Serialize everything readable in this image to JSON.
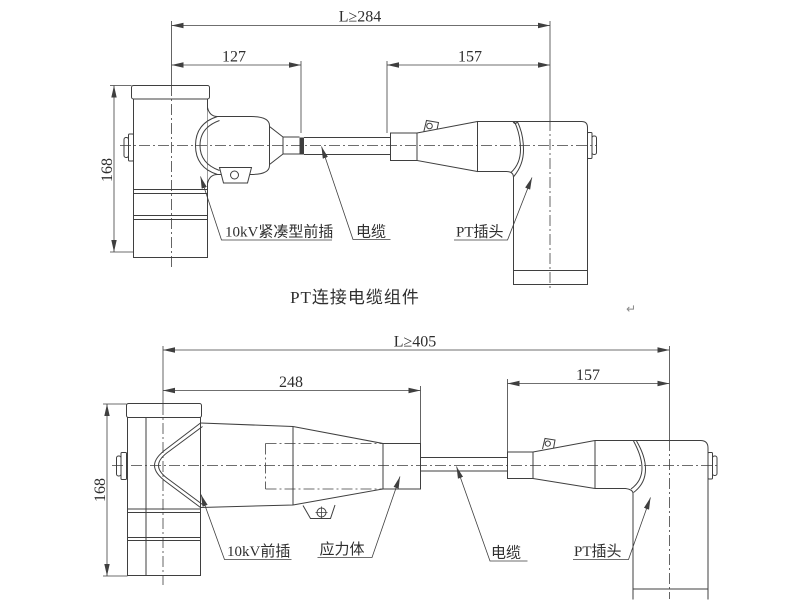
{
  "colors": {
    "line": "#3f3f3f",
    "text": "#2e2e2e",
    "background": "#ffffff",
    "mark": "#8a8a8a"
  },
  "title": "PT连接电缆组件",
  "paragraph_mark": "↵",
  "top_view": {
    "dim_overall": "L≥284",
    "dim_front_length": "127",
    "dim_plug_length": "157",
    "dim_height": "168",
    "label_front_plug": "10kV紧凑型前插",
    "label_cable": "电缆",
    "label_pt_plug": "PT插头"
  },
  "bottom_view": {
    "dim_overall": "L≥405",
    "dim_front_length": "248",
    "dim_plug_length": "157",
    "dim_height": "168",
    "label_front_plug": "10kV前插",
    "label_stress_body": "应力体",
    "label_cable": "电缆",
    "label_pt_plug": "PT插头"
  }
}
